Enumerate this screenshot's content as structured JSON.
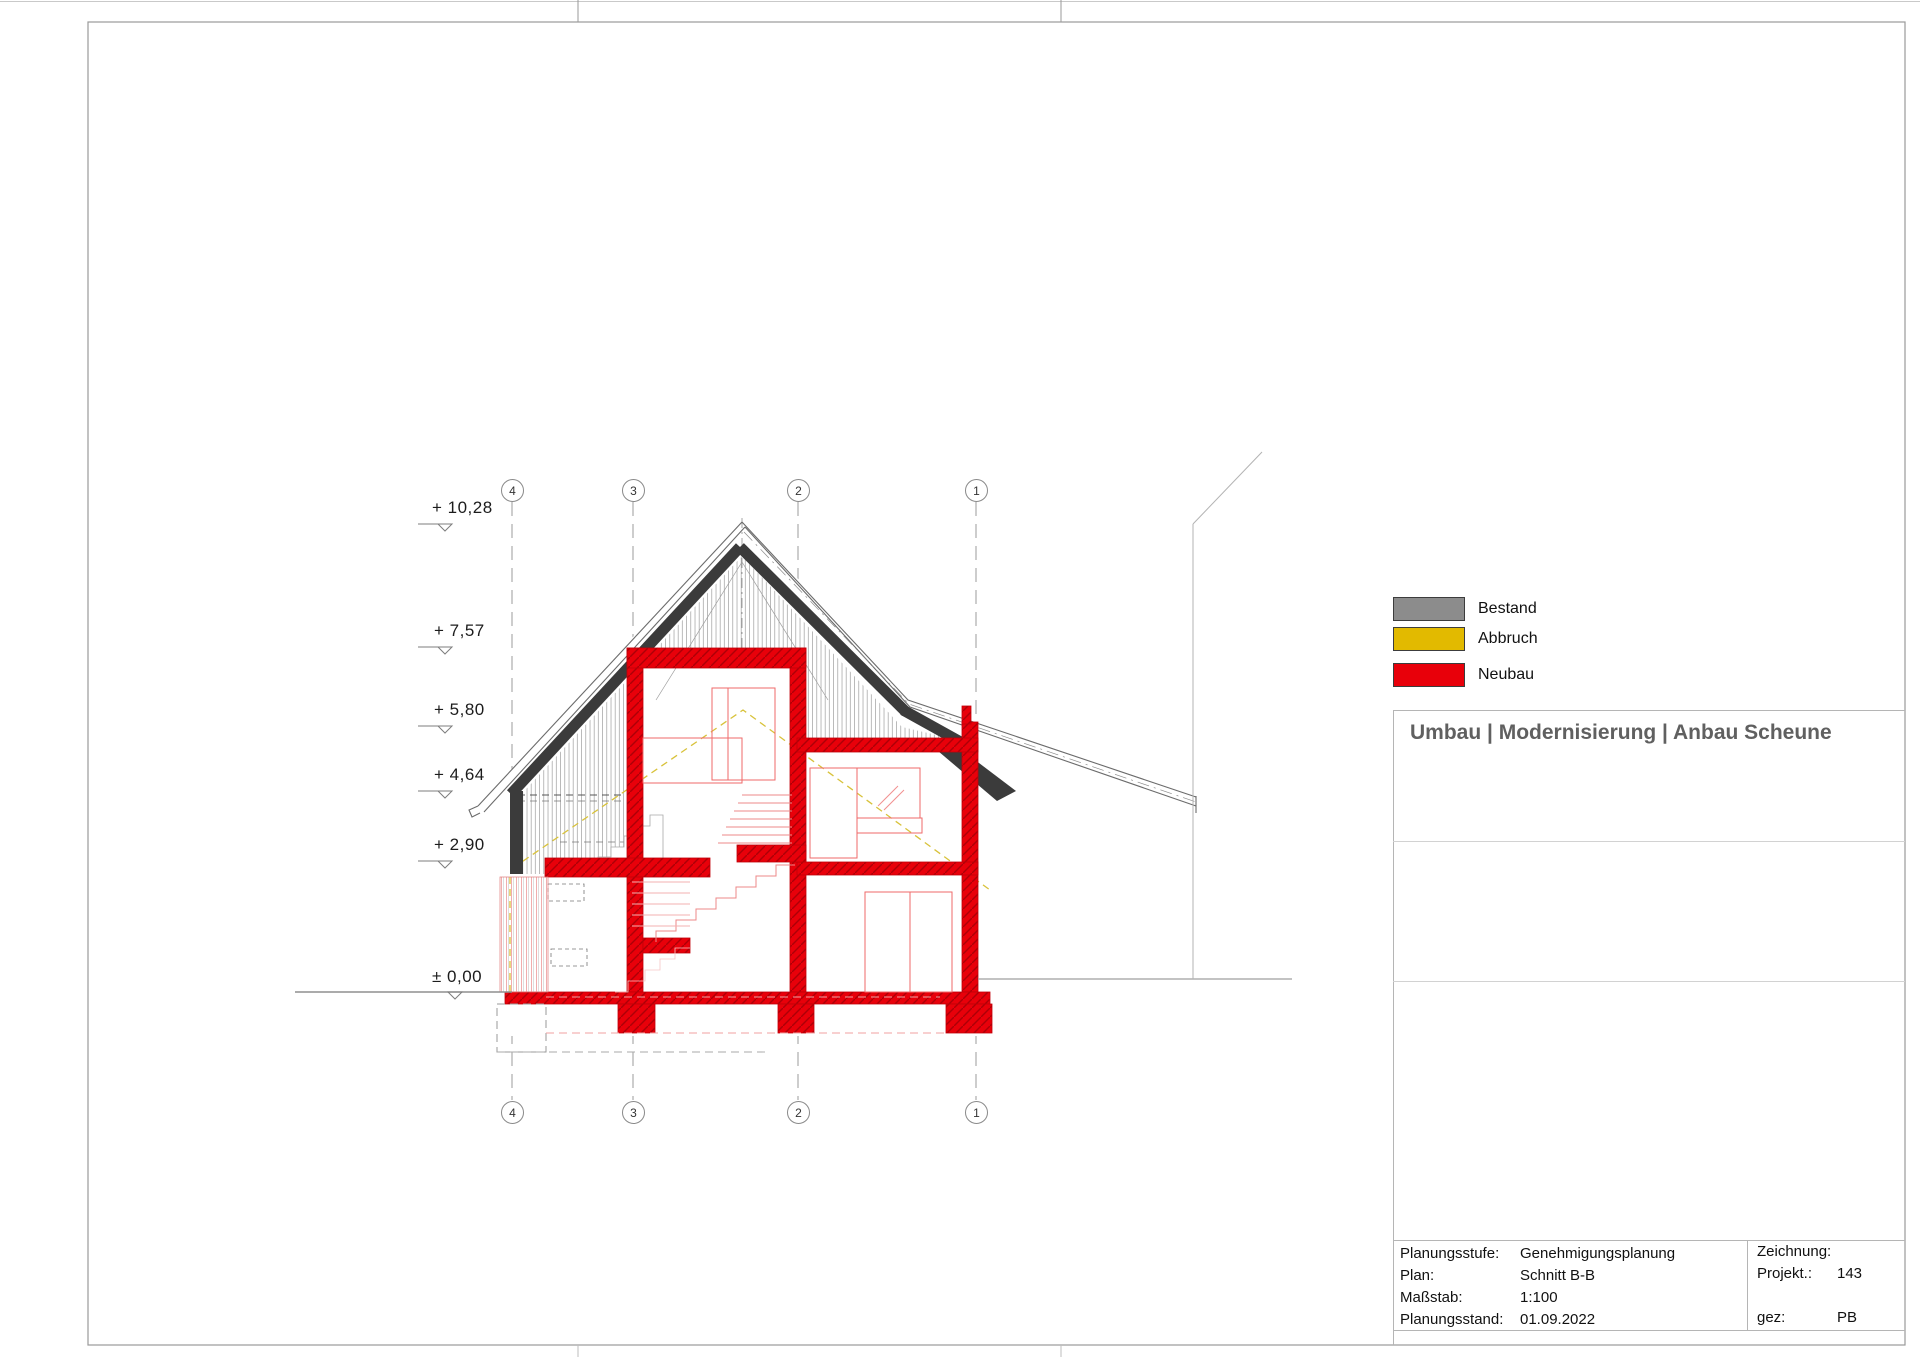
{
  "drawing": {
    "elevations": [
      "+ 10,28",
      "+ 7,57",
      "+ 5,80",
      "+ 4,64",
      "+ 2,90",
      "± 0,00"
    ],
    "grid_labels": [
      "4",
      "3",
      "2",
      "1"
    ],
    "colors": {
      "neubau": "#e8000a",
      "bestand_dark": "#3b3b3b",
      "abbruch_dashed": "#d8c23a",
      "hatch_gray": "#8d8d8d"
    }
  },
  "legend": {
    "items": [
      {
        "label": "Bestand",
        "color": "#8c8c8c"
      },
      {
        "label": "Abbruch",
        "color": "#e2ba00"
      },
      {
        "label": "Neubau",
        "color": "#e8000a"
      }
    ]
  },
  "panel": {
    "title": "Umbau | Modernisierung | Anbau Scheune"
  },
  "titleblock": {
    "rows": [
      {
        "label": "Planungsstufe:",
        "value": "Genehmigungsplanung"
      },
      {
        "label": "Plan:",
        "value": "Schnitt B-B"
      },
      {
        "label": "Maßstab:",
        "value": "1:100"
      },
      {
        "label": "Planungsstand:",
        "value": "01.09.2022"
      }
    ],
    "right_rows": [
      {
        "label": "Zeichnung:",
        "value": ""
      },
      {
        "label": "Projekt.:",
        "value": "143"
      },
      {
        "label": "gez:",
        "value": "PB"
      }
    ]
  }
}
